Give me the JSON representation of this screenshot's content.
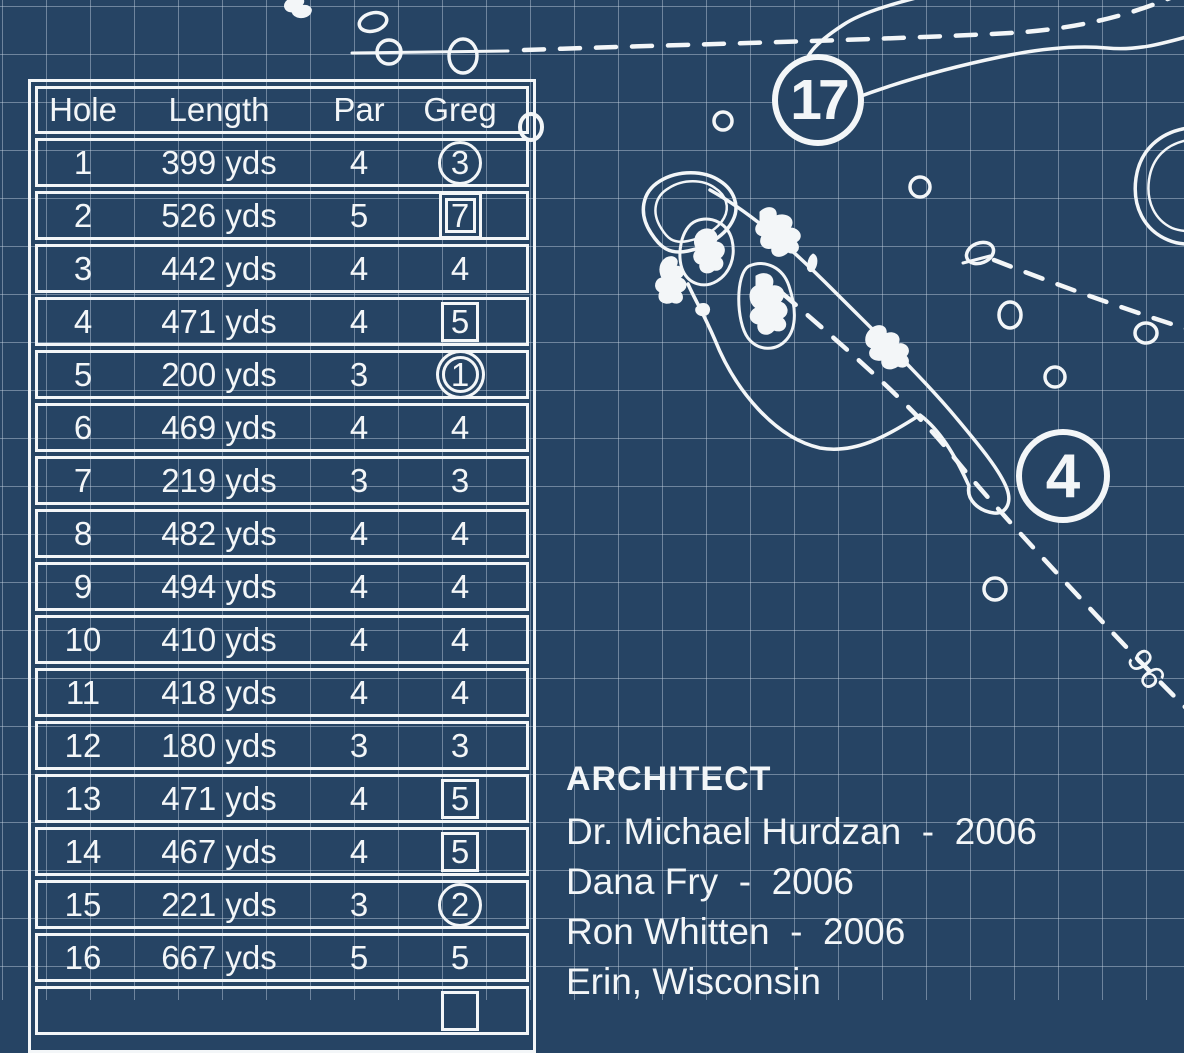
{
  "palette": {
    "background": "#264464",
    "line": "#f3f6f8",
    "grid": "rgba(198,212,226,0.45)"
  },
  "scorecard": {
    "headers": [
      "Hole",
      "Length",
      "Par",
      "Greg"
    ],
    "rows": [
      {
        "hole": "1",
        "length": "399 yds",
        "par": "4",
        "score": "3",
        "mark": "circle"
      },
      {
        "hole": "2",
        "length": "526 yds",
        "par": "5",
        "score": "7",
        "mark": "double-square"
      },
      {
        "hole": "3",
        "length": "442 yds",
        "par": "4",
        "score": "4",
        "mark": "none"
      },
      {
        "hole": "4",
        "length": "471 yds",
        "par": "4",
        "score": "5",
        "mark": "square"
      },
      {
        "hole": "5",
        "length": "200 yds",
        "par": "3",
        "score": "1",
        "mark": "double-circle"
      },
      {
        "hole": "6",
        "length": "469 yds",
        "par": "4",
        "score": "4",
        "mark": "none"
      },
      {
        "hole": "7",
        "length": "219 yds",
        "par": "3",
        "score": "3",
        "mark": "none"
      },
      {
        "hole": "8",
        "length": "482 yds",
        "par": "4",
        "score": "4",
        "mark": "none"
      },
      {
        "hole": "9",
        "length": "494 yds",
        "par": "4",
        "score": "4",
        "mark": "none"
      },
      {
        "hole": "10",
        "length": "410 yds",
        "par": "4",
        "score": "4",
        "mark": "none"
      },
      {
        "hole": "11",
        "length": "418 yds",
        "par": "4",
        "score": "4",
        "mark": "none"
      },
      {
        "hole": "12",
        "length": "180 yds",
        "par": "3",
        "score": "3",
        "mark": "none"
      },
      {
        "hole": "13",
        "length": "471 yds",
        "par": "4",
        "score": "5",
        "mark": "square"
      },
      {
        "hole": "14",
        "length": "467 yds",
        "par": "4",
        "score": "5",
        "mark": "square"
      },
      {
        "hole": "15",
        "length": "221 yds",
        "par": "3",
        "score": "2",
        "mark": "circle"
      },
      {
        "hole": "16",
        "length": "667 yds",
        "par": "5",
        "score": "5",
        "mark": "none"
      },
      {
        "hole": "",
        "length": "",
        "par": "",
        "score": "",
        "mark": "square",
        "partial": true
      }
    ]
  },
  "architect": {
    "title": "ARCHITECT",
    "lines": [
      "Dr. Michael Hurdzan  -  2006",
      "Dana Fry  -  2006",
      "Ron Whitten  -  2006",
      "Erin, Wisconsin"
    ]
  },
  "map": {
    "hole_markers": [
      {
        "number": "17"
      },
      {
        "number": "4"
      }
    ],
    "yardage_label": "96"
  }
}
